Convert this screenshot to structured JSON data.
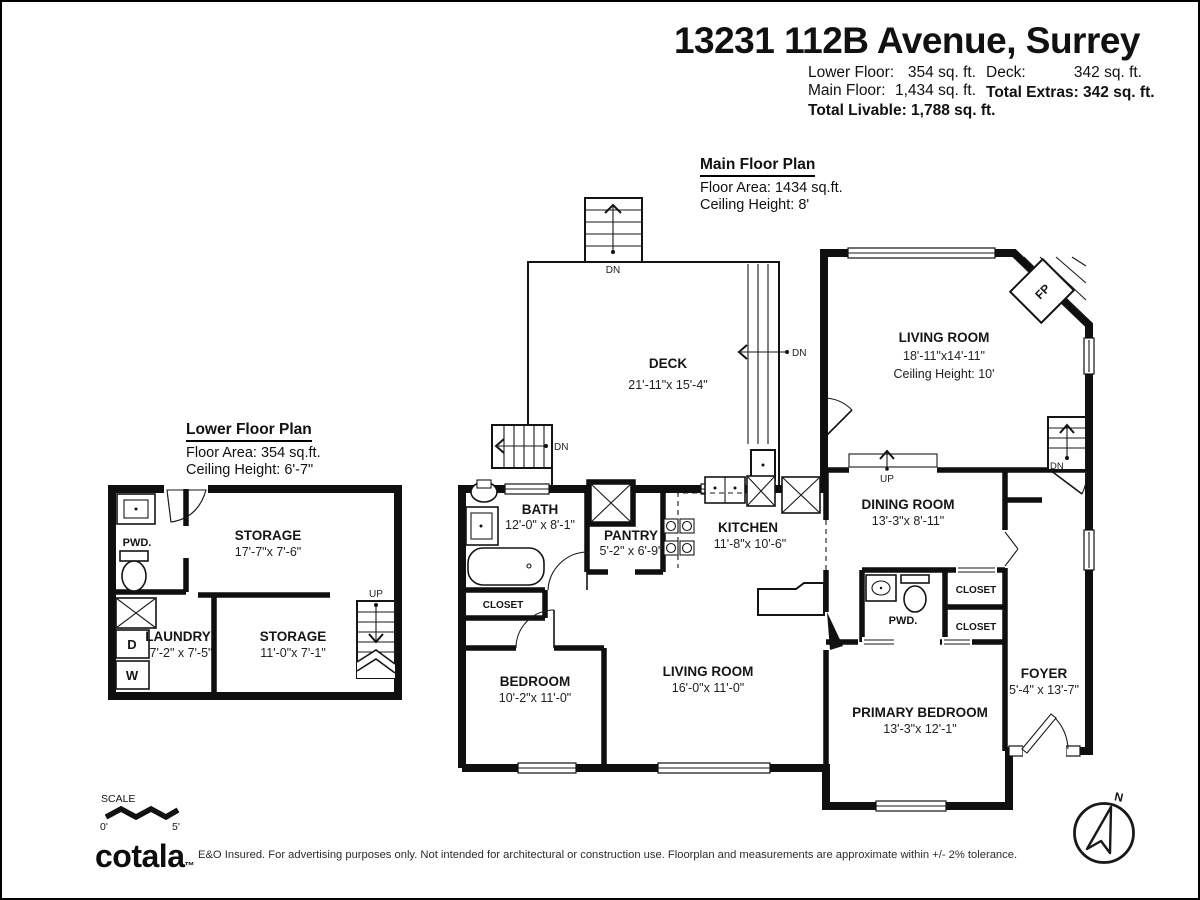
{
  "header": {
    "title": "13231 112B Avenue, Surrey",
    "stats": {
      "lower_floor_label": "Lower Floor:",
      "lower_floor_value": "354 sq. ft.",
      "main_floor_label": "Main Floor:",
      "main_floor_value": "1,434 sq. ft.",
      "total_livable": "Total Livable: 1,788 sq. ft.",
      "deck_label": "Deck:",
      "deck_value": "342 sq. ft.",
      "total_extras": "Total Extras: 342 sq. ft."
    }
  },
  "main_floor": {
    "title": "Main Floor Plan",
    "floor_area": "Floor Area: 1434 sq.ft.",
    "ceiling_height": "Ceiling Height: 8'",
    "rooms": {
      "deck": {
        "name": "DECK",
        "dims": "21'-11\"x 15'-4\""
      },
      "living_room": {
        "name": "LIVING ROOM",
        "dims": "18'-11\"x14'-11\"",
        "ceiling": "Ceiling Height: 10'"
      },
      "bath": {
        "name": "BATH",
        "dims": "12'-0\" x 8'-1\""
      },
      "pantry": {
        "name": "PANTRY",
        "dims": "5'-2\" x 6'-9\""
      },
      "kitchen": {
        "name": "KITCHEN",
        "dims": "11'-8\"x 10'-6\""
      },
      "dining_room": {
        "name": "DINING ROOM",
        "dims": "13'-3\"x 8'-11\""
      },
      "bedroom": {
        "name": "BEDROOM",
        "dims": "10'-2\"x 11'-0\""
      },
      "living_room_main": {
        "name": "LIVING ROOM",
        "dims": "16'-0\"x 11'-0\""
      },
      "primary_bedroom": {
        "name": "PRIMARY BEDROOM",
        "dims": "13'-3\"x 12'-1\""
      },
      "foyer": {
        "name": "FOYER",
        "dims": "5'-4\" x 13'-7\""
      }
    },
    "labels": {
      "up": "UP",
      "dn": "DN",
      "fp": "FP",
      "pwd": "PWD.",
      "closet": "CLOSET"
    }
  },
  "lower_floor": {
    "title": "Lower Floor Plan",
    "floor_area": "Floor Area: 354 sq.ft.",
    "ceiling_height": "Ceiling Height: 6'-7\"",
    "rooms": {
      "storage_upper": {
        "name": "STORAGE",
        "dims": "17'-7\"x 7'-6\""
      },
      "storage_lower": {
        "name": "STORAGE",
        "dims": "11'-0\"x 7'-1\""
      },
      "laundry": {
        "name": "LAUNDRY",
        "dims": "7'-2\" x 7'-5\""
      }
    },
    "labels": {
      "pwd": "PWD.",
      "up": "UP",
      "dryer": "D",
      "washer": "W"
    }
  },
  "footer": {
    "scale_label": "SCALE",
    "scale_zero": "0'",
    "scale_five": "5'",
    "brand": "cotala",
    "brand_tm": "™",
    "disclaimer": "E&O Insured. For advertising purposes only. Not intended for architectural or construction use. Floorplan and measurements are approximate within +/- 2% tolerance.",
    "compass_north": "N"
  }
}
